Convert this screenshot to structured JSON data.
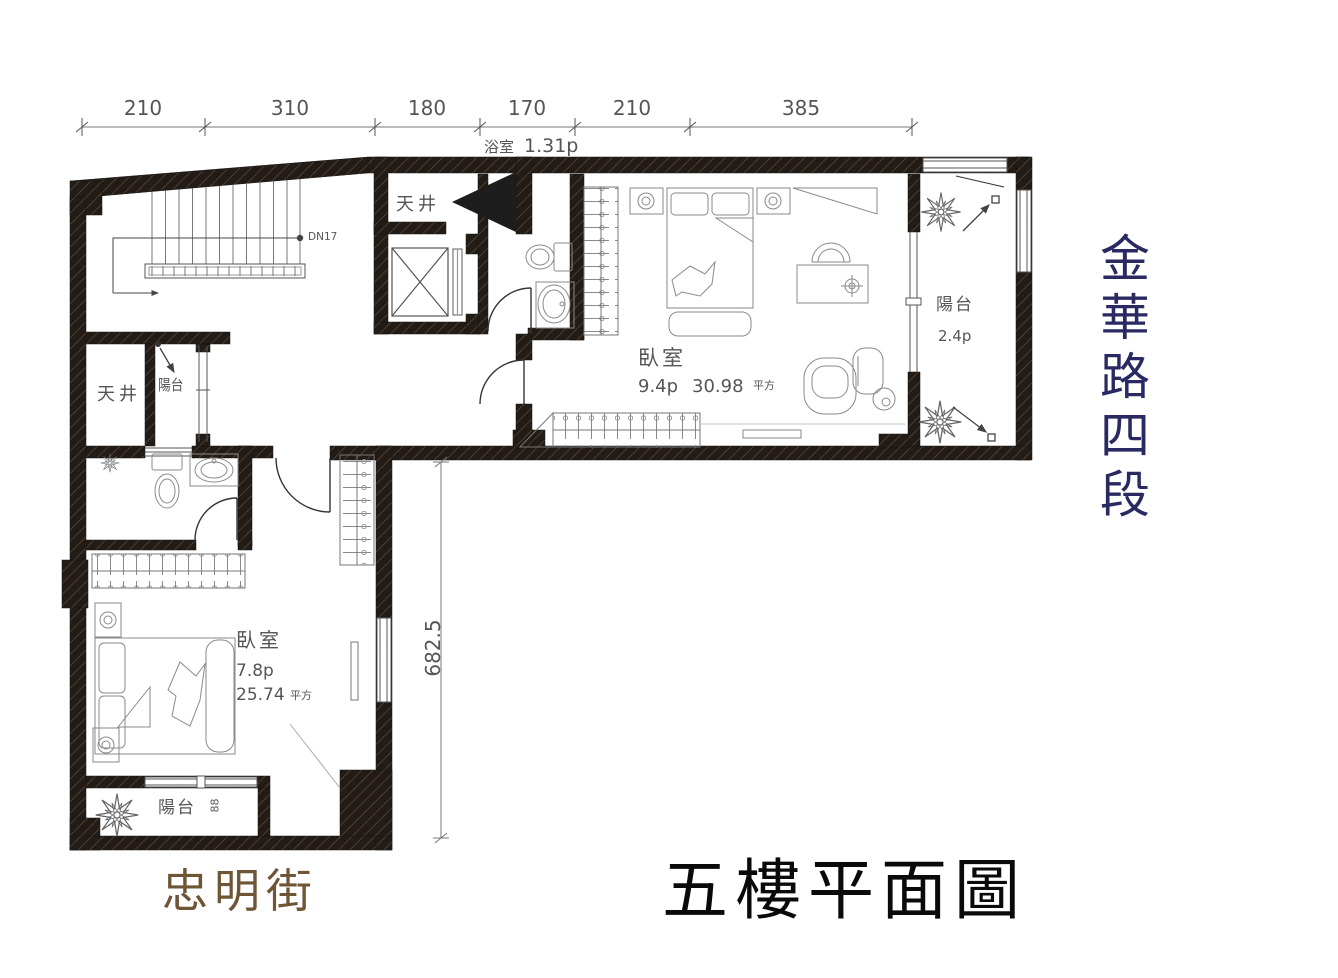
{
  "title": "五樓平面圖",
  "streets": {
    "right": "金華路四段",
    "bottom": "忠明街"
  },
  "dimensions": {
    "top": [
      "210",
      "310",
      "180",
      "170",
      "210",
      "385"
    ],
    "left": "682.5"
  },
  "labels": {
    "bath_top_name": "浴室",
    "bath_top_area": "1.31p",
    "lightwell_top": "天井",
    "lightwell_left": "天井",
    "balcony_left": "陽台",
    "stairs_note": "DN17",
    "bedroom_right_name": "臥室",
    "bedroom_right_area_p": "9.4p",
    "bedroom_right_area_m2": "30.98",
    "bedroom_right_area_unit": "平方",
    "balcony_right_name": "陽台",
    "balcony_right_area": "2.4p",
    "bedroom_lower_name": "臥室",
    "bedroom_lower_area_p": "7.8p",
    "bedroom_lower_area_m2": "25.74",
    "bedroom_lower_area_unit": "平方",
    "balcony_bottom_name": "陽台",
    "balcony_bottom_note": "88"
  },
  "colors": {
    "street_right": "#2a2a63",
    "street_bottom": "#6e5536",
    "title": "#0a0a0a",
    "wall": "#231b15",
    "cad_line": "#555555"
  }
}
